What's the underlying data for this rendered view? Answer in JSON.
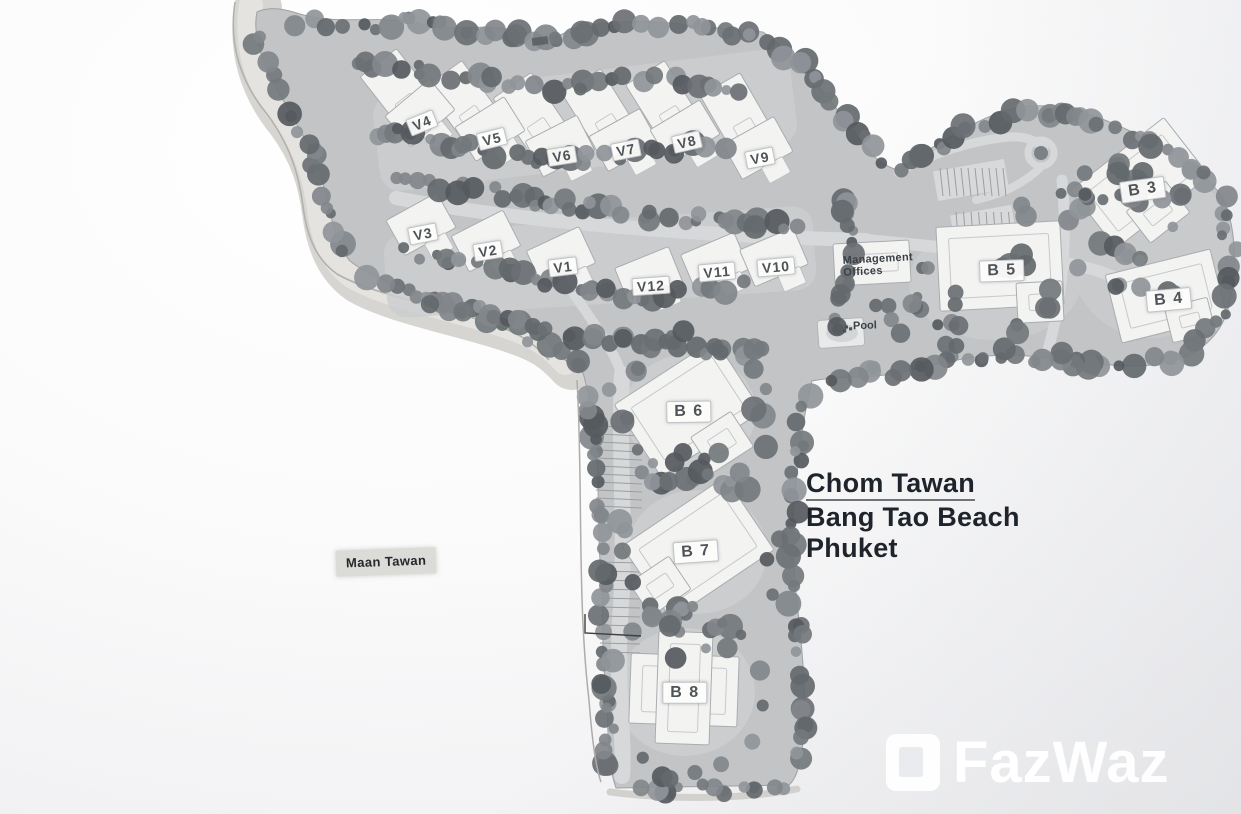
{
  "site": {
    "title": {
      "line1": "Chom Tawan",
      "line2": "Bang Tao Beach",
      "line3": "Phuket"
    },
    "neighbor_label": "Maan Tawan",
    "management_offices": {
      "line1": "Management",
      "line2": "Offices"
    },
    "pool_label": "Pool",
    "watermark_text": "FazWaz",
    "villas": [
      {
        "label": "V4",
        "x": 422,
        "y": 123,
        "rot": -22
      },
      {
        "label": "V5",
        "x": 492,
        "y": 139,
        "rot": -14
      },
      {
        "label": "V6",
        "x": 562,
        "y": 156,
        "rot": -9
      },
      {
        "label": "V7",
        "x": 626,
        "y": 150,
        "rot": -11
      },
      {
        "label": "V8",
        "x": 687,
        "y": 142,
        "rot": -13
      },
      {
        "label": "V9",
        "x": 760,
        "y": 158,
        "rot": -11
      },
      {
        "label": "V3",
        "x": 423,
        "y": 234,
        "rot": -11
      },
      {
        "label": "V2",
        "x": 488,
        "y": 251,
        "rot": -9
      },
      {
        "label": "V1",
        "x": 563,
        "y": 267,
        "rot": -7
      },
      {
        "label": "V12",
        "x": 651,
        "y": 286,
        "rot": -4
      },
      {
        "label": "V11",
        "x": 717,
        "y": 272,
        "rot": -5
      },
      {
        "label": "V10",
        "x": 776,
        "y": 267,
        "rot": -5
      }
    ],
    "buildings": [
      {
        "label": "B 3",
        "x": 1143,
        "y": 190,
        "rot": -8
      },
      {
        "label": "B 4",
        "x": 1169,
        "y": 300,
        "rot": -5
      },
      {
        "label": "B 5",
        "x": 1002,
        "y": 271,
        "rot": -2
      },
      {
        "label": "B 6",
        "x": 689,
        "y": 412,
        "rot": -1
      },
      {
        "label": "B 7",
        "x": 696,
        "y": 552,
        "rot": -4
      },
      {
        "label": "B 8",
        "x": 685,
        "y": 693,
        "rot": 0
      }
    ]
  },
  "colors": {
    "ink": "#1f232b",
    "badge_text": "#4e5358",
    "ground": "#c2c4c6",
    "sand": "#d6d5d2",
    "road": "#d7d8d9",
    "tree_dark": "#565a5e",
    "tree_light": "#90959a",
    "building_fill": "#f3f3f2"
  }
}
